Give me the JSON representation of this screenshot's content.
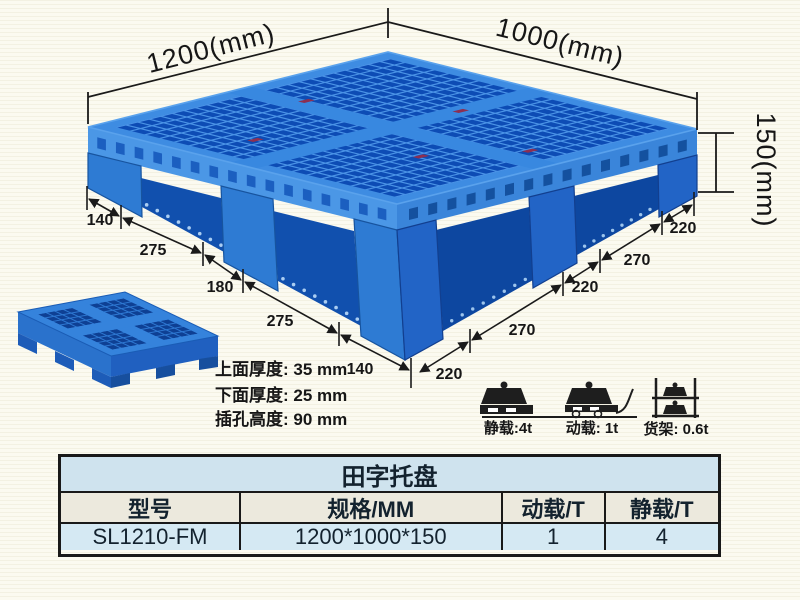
{
  "product_drawing": {
    "dim_length": "1200(mm)",
    "dim_width": "1000(mm)",
    "dim_height": "150(mm)",
    "left_edge_segments": [
      "140",
      "275",
      "180",
      "275",
      "140"
    ],
    "right_edge_segments": [
      "220",
      "270",
      "220",
      "270",
      "220"
    ]
  },
  "thickness_specs": {
    "line1": "上面厚度: 35 mm",
    "line2": "下面厚度: 25 mm",
    "line3": "插孔高度: 90 mm"
  },
  "load_ratings": {
    "static": {
      "icon": "static-load-icon",
      "label": "静载:4t"
    },
    "dynamic": {
      "icon": "dynamic-load-icon",
      "label": "动载: 1t"
    },
    "rack": {
      "icon": "rack-load-icon",
      "label": "货架: 0.6t"
    }
  },
  "spec_table": {
    "title": "田字托盘",
    "headers": [
      "型号",
      "规格/MM",
      "动载/T",
      "静载/T"
    ],
    "row": [
      "SL1210-FM",
      "1200*1000*150",
      "1",
      "4"
    ]
  },
  "colors": {
    "pallet_blue": "#2e7bd3",
    "pallet_dark_hole": "#0d4cb5",
    "pallet_rib": "#4a93e6",
    "band_blue": "#3e8ce2",
    "side_rail": "#1150ae",
    "tag_maroon": "#8c2f52",
    "line_black": "#1a1a1a",
    "table_title_bg": "#cfe3ee",
    "table_header_bg": "#ece9dd",
    "table_row_bg": "#d5e9f3",
    "background": "#fbfaf0"
  }
}
